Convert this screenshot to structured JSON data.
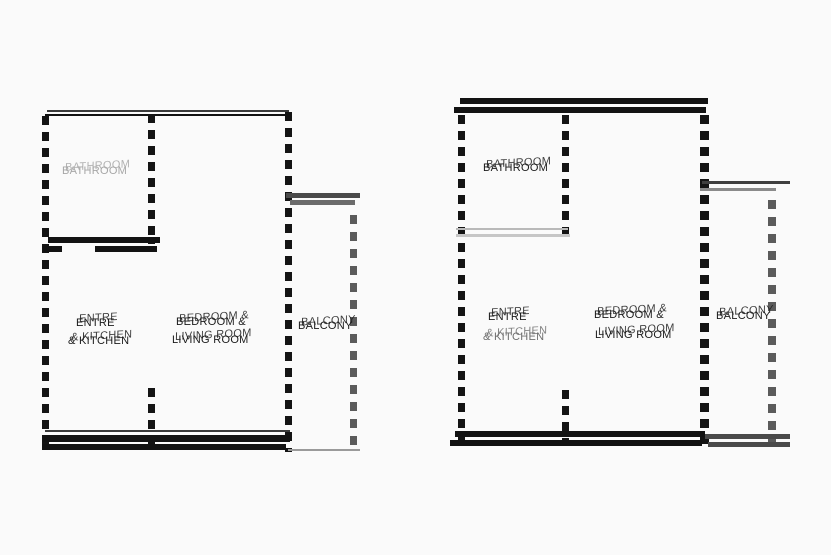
{
  "page": {
    "type": "architectural floor plans",
    "background": "#fafafa"
  },
  "colors": {
    "wall": "#121212",
    "balcony_wall": "#4a4a4a",
    "light_wall": "#b9b9b9",
    "text": "#1a1a1a",
    "faint_text": "#a6a6a6"
  },
  "plans": [
    {
      "title": "left-plan",
      "rooms": {
        "bathroom": "BATHROOM",
        "kitchen_line1": "ENTRE",
        "kitchen_line2": "& KITCHEN",
        "living_line1": "BEDROOM &",
        "living_line2": "LIVING ROOM",
        "balcony": "BALCONY"
      }
    },
    {
      "title": "right-plan",
      "rooms": {
        "bathroom": "BATHROOM",
        "kitchen_line1": "ENTRE",
        "kitchen_line2": "& KITCHEN",
        "living_line1": "BEDROOM &",
        "living_line2": "LIVING ROOM",
        "balcony": "BALCONY"
      }
    }
  ]
}
